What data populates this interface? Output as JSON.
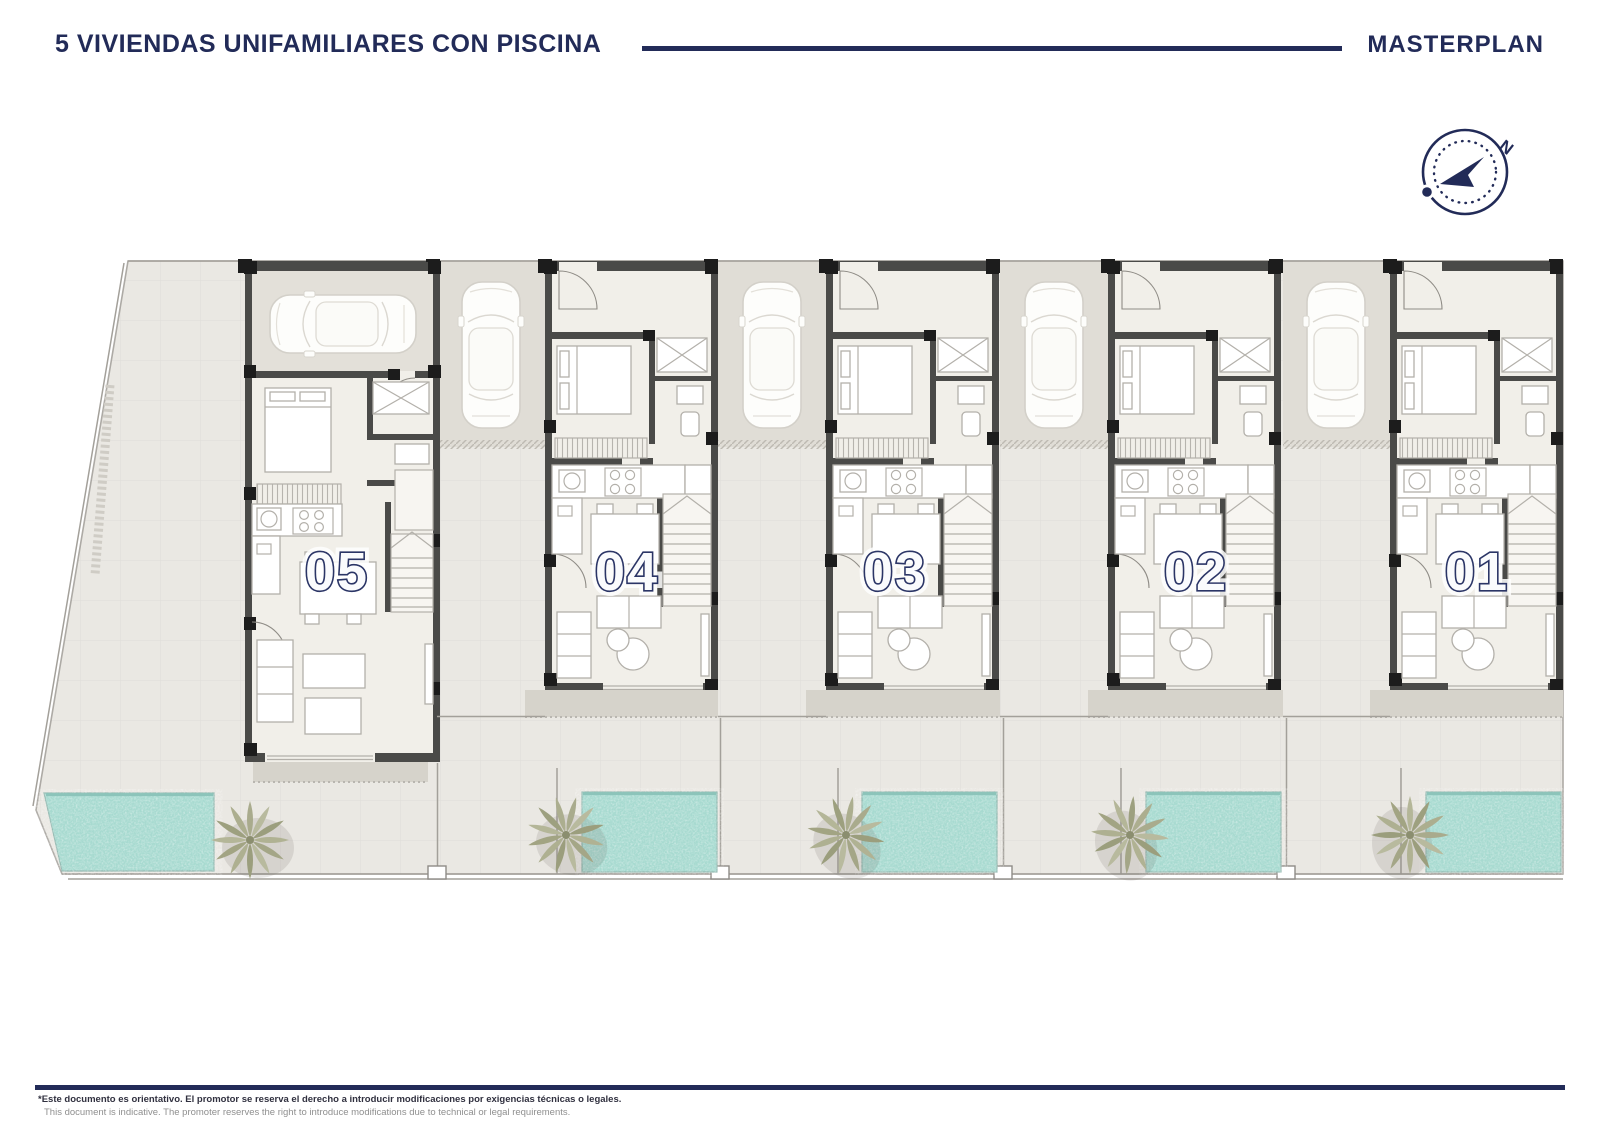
{
  "header": {
    "title": "5 VIVIENDAS UNIFAMILIARES CON PISCINA",
    "right_label": "MASTERPLAN"
  },
  "compass": {
    "north_label": "N"
  },
  "units": [
    {
      "label": "05"
    },
    {
      "label": "04"
    },
    {
      "label": "03"
    },
    {
      "label": "02"
    },
    {
      "label": "01"
    }
  ],
  "footer": {
    "disclaimer_es": "*Este documento es orientativo. El promotor se reserva el derecho a introducir modificaciones por exigencias técnicas o legales.",
    "disclaimer_en": "This document is indicative. The promoter reserves the right to introduce modifications due to technical or legal requirements."
  },
  "colors": {
    "navy": "#222b58",
    "ground": "#eae8e3",
    "driveway": "#e0ddd6",
    "wall": "#4a4a48",
    "pool": "#a7dad0",
    "palm": "#a9ab8d"
  }
}
